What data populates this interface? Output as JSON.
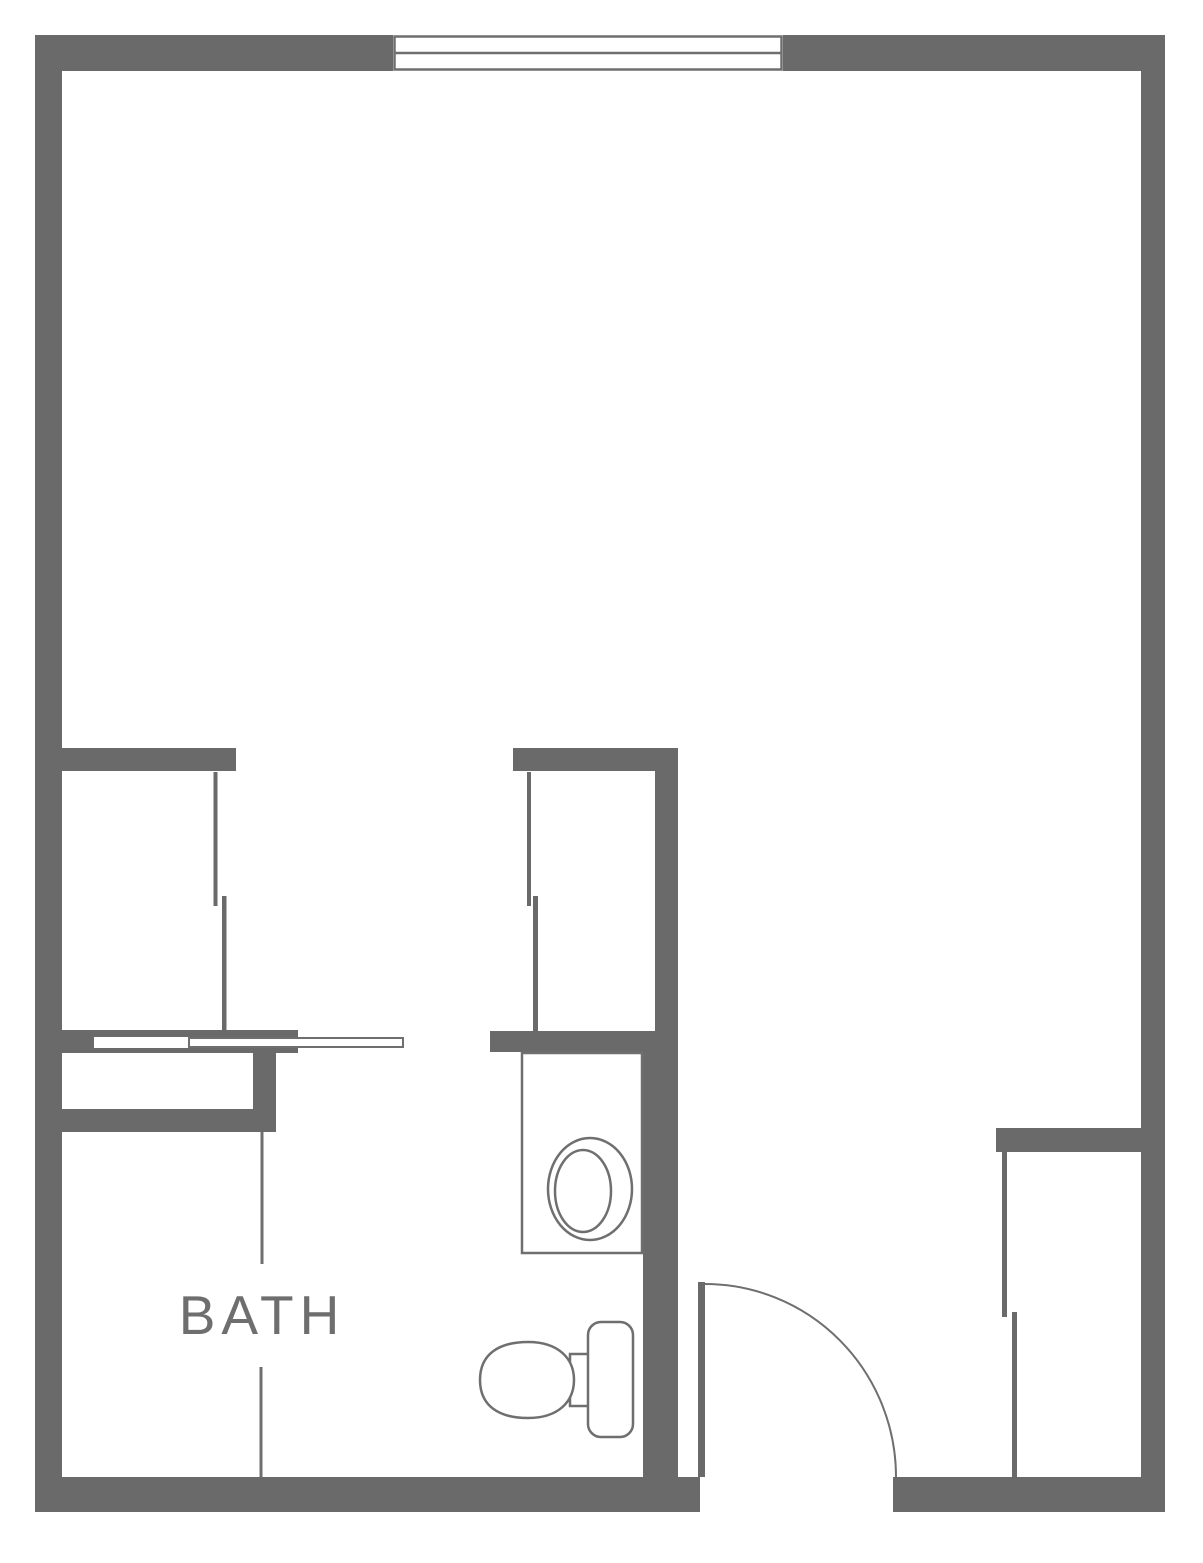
{
  "plan": {
    "room_label": "BATH",
    "fixtures": {
      "window": "window",
      "toilet": "toilet",
      "sink": "oval-sink",
      "vanity": "vanity-counter",
      "door": "entry-door-swing",
      "closet_doors": "bypass-sliding-doors"
    }
  },
  "colors": {
    "wall": "#6a6a6a",
    "line": "#6f6f6f",
    "label": "#6e6e6e",
    "bg": "#ffffff",
    "fixture": "#ffffff"
  }
}
